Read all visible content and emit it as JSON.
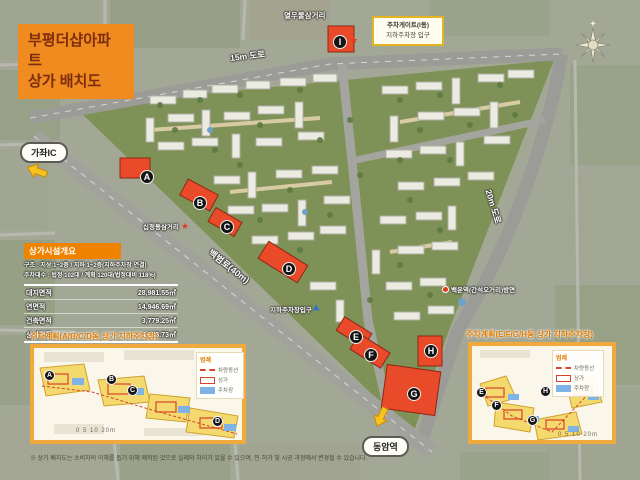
{
  "title": {
    "line1": "부평더샵아파트",
    "line2": "상가 배치도"
  },
  "map": {
    "compass_label": "N",
    "road_labels": {
      "top": "15m 도로",
      "right": "20m 도로",
      "diagonal": "백범로(40m)"
    },
    "poi": {
      "top_intersection": "열우물삼거리",
      "left_intersection": "십정동삼거리",
      "parking_entrance": "지하주차장입구",
      "station_direction": "백운역(간석오거리)방면"
    },
    "direction_pills": {
      "northwest": "가좌IC",
      "south": "동암역"
    },
    "gate_callout": {
      "line1": "주차게이트(I동)",
      "line2": "지하주차장 입구"
    },
    "buildings": [
      {
        "letter": "A"
      },
      {
        "letter": "B"
      },
      {
        "letter": "C"
      },
      {
        "letter": "D"
      },
      {
        "letter": "E"
      },
      {
        "letter": "F"
      },
      {
        "letter": "G"
      },
      {
        "letter": "H"
      },
      {
        "letter": "I"
      }
    ],
    "colors": {
      "commercial": "#e84a2a",
      "site_green": "#7e9156",
      "road": "#9b9b97",
      "accent_orange": "#ef8b1f"
    }
  },
  "overview": {
    "header": "상가시설개요",
    "notes": [
      "구조 : 지상 1~2층 / 지하 1~2층(지하주차장 연결)",
      "주차대수 : 법정 102대 / 계획 120대(법정대비 118%)"
    ],
    "rows": [
      {
        "label": "대지면적",
        "value": "28,981.55㎡"
      },
      {
        "label": "연면적",
        "value": "14,946.69㎡"
      },
      {
        "label": "건축면적",
        "value": "3,779.25㎡"
      },
      {
        "label": "상가면적",
        "value": "4,835.73㎡"
      }
    ]
  },
  "inset_left": {
    "title": "주차계획(A/B/C/D동 상가 지하주차장)",
    "legend": {
      "title": "범례",
      "items": [
        "차량동선",
        "상가",
        "주차장"
      ]
    },
    "buildings": [
      {
        "letter": "A"
      },
      {
        "letter": "B"
      },
      {
        "letter": "C"
      },
      {
        "letter": "D"
      }
    ],
    "scale": "0 5 10 20m"
  },
  "inset_right": {
    "title": "주차계획(E/F/G/H동 상가 지하주차장)",
    "legend": {
      "title": "범례",
      "items": [
        "차량동선",
        "상가",
        "주차장"
      ]
    },
    "buildings": [
      {
        "letter": "E"
      },
      {
        "letter": "F"
      },
      {
        "letter": "G"
      },
      {
        "letter": "H"
      }
    ],
    "scale": "0 5 10 20m"
  },
  "footnote": "※ 상기 배치도는 소비자의 이해를 돕기 위해 제작된 것으로 실제와 차이가 있을 수 있으며, 인·허가 및 시공 과정에서 변경될 수 있습니다."
}
